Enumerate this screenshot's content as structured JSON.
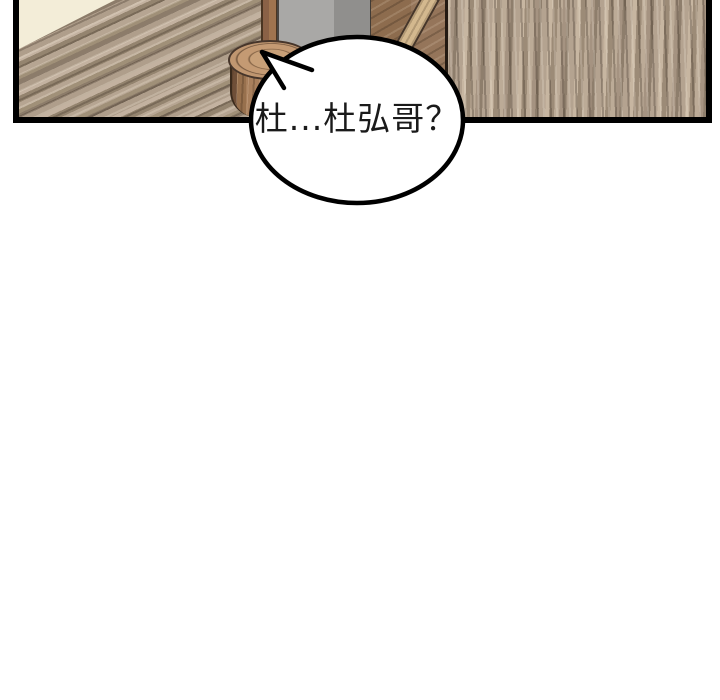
{
  "scene": {
    "kind": "comic-panel",
    "description_names": [
      "wood-floor",
      "wall-corner",
      "stool",
      "gray-pillar",
      "chair",
      "speech-bubble"
    ]
  },
  "speech_bubble": {
    "text": "杜...杜弘哥？",
    "fill": "#ffffff",
    "stroke": "#000000"
  },
  "palette": {
    "panel-border": "#000000",
    "text-color": "#1a1a1a",
    "bubble-fill": "#ffffff",
    "bubble-stroke": "#000000",
    "floor-left-base": "#ab9a87",
    "floor-right-base": "#b7a691",
    "wall": "#f3edd8",
    "stool-top": "#c49a73",
    "stool-side": "#a87f5c",
    "pillar-light": "#a9a8a6",
    "pillar-dark": "#908f8d",
    "wood-strip": "#8a6146",
    "chair-wood": "#95755a",
    "chair-strut": "#d3b88e"
  }
}
